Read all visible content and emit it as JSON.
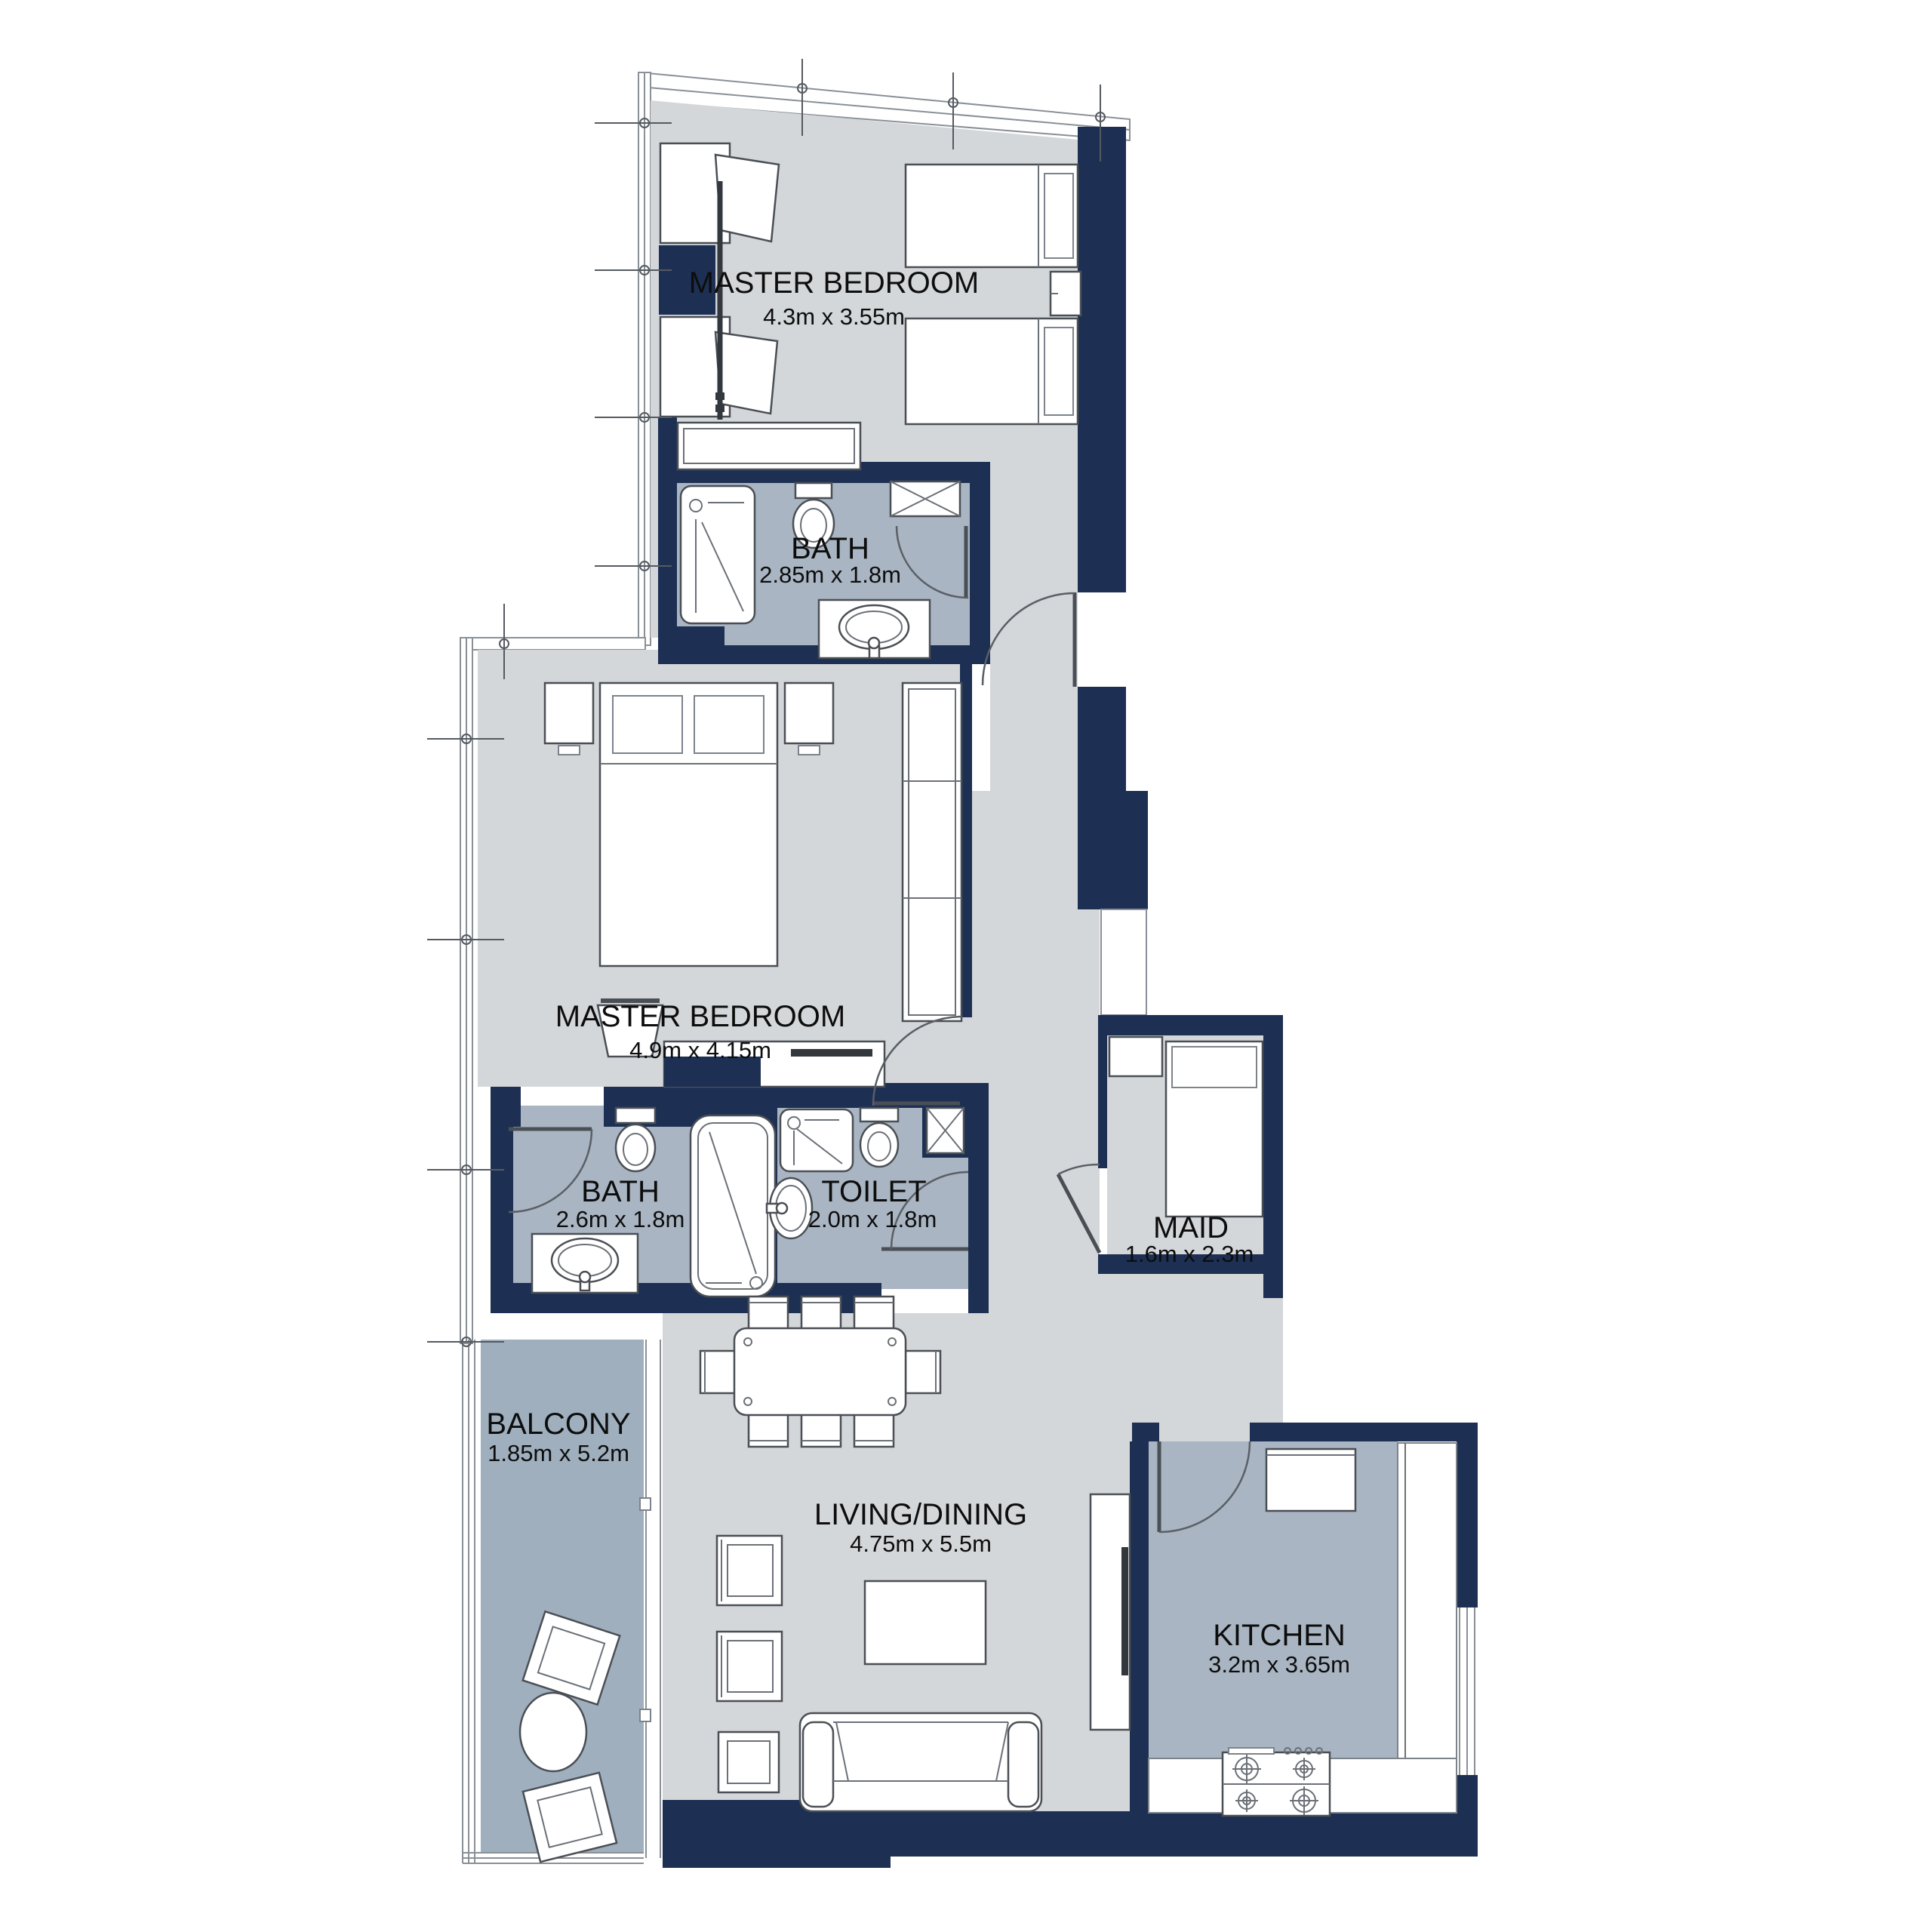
{
  "floorplan": {
    "rooms": {
      "master_bedroom_1": {
        "name": "MASTER BEDROOM",
        "dims": "4.3m x 3.55m"
      },
      "bath_1": {
        "name": "BATH",
        "dims": "2.85m x 1.8m"
      },
      "master_bedroom_2": {
        "name": "MASTER BEDROOM",
        "dims": "4.9m x 4.15m"
      },
      "bath_2": {
        "name": "BATH",
        "dims": "2.6m x 1.8m"
      },
      "toilet": {
        "name": "TOILET",
        "dims": "2.0m x 1.8m"
      },
      "maid": {
        "name": "MAID",
        "dims": "1.6m x 2.3m"
      },
      "balcony": {
        "name": "BALCONY",
        "dims": "1.85m x 5.2m"
      },
      "living_dining": {
        "name": "LIVING/DINING",
        "dims": "4.75m x 5.5m"
      },
      "kitchen": {
        "name": "KITCHEN",
        "dims": "3.2m x 3.65m"
      }
    },
    "colors": {
      "wall": "#1d3053",
      "floor": "#d4d7da",
      "wet_floor": "#a9b5c2",
      "balcony_floor": "#9fafbe",
      "outline": "#6b7077"
    }
  }
}
